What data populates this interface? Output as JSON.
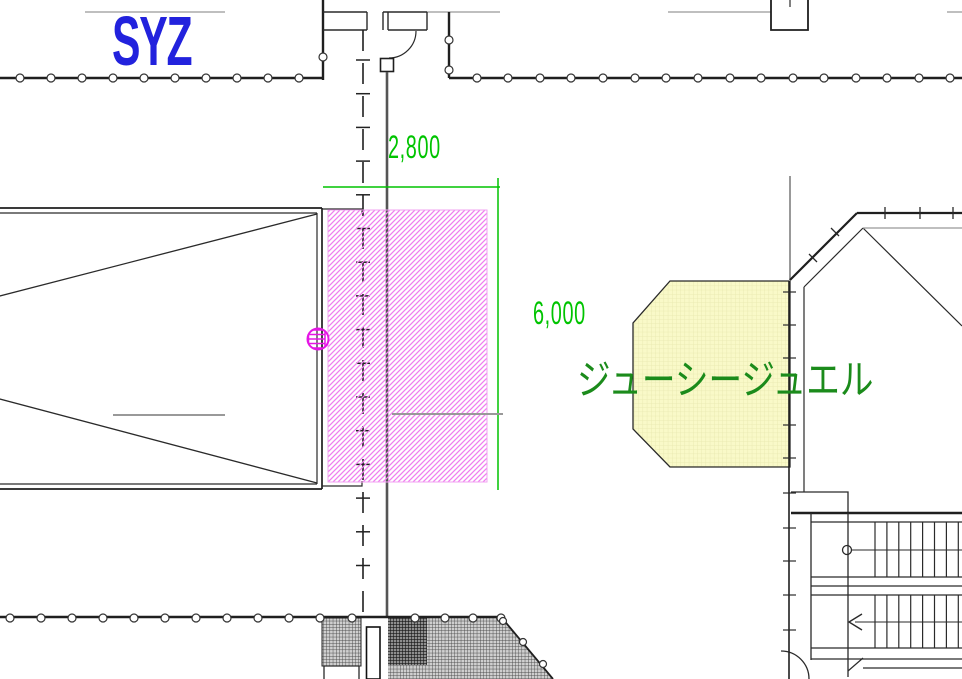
{
  "drawing": {
    "title_label": "SYZ",
    "tenant_label": "ジューシージュエル",
    "dimensions": {
      "width_label": "2,800",
      "height_label": "6,000"
    }
  },
  "colors": {
    "blue": "#2222dd",
    "dim-green": "#00c400",
    "tenant-green": "#1b8b1b",
    "magenta": "#e516e5",
    "pink-hatch": "#ef7fef",
    "yellow-fill": "#f9f9c8",
    "line-black": "#1f1f1f",
    "line-gray": "#999999"
  }
}
